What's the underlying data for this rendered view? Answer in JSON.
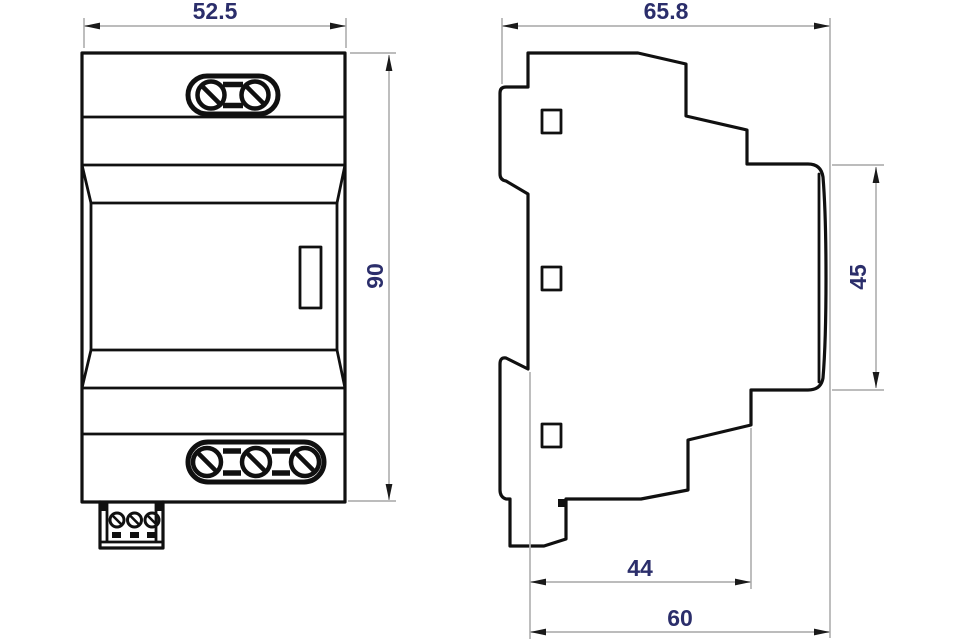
{
  "title": "DIN rail module dimensional drawing",
  "colors": {
    "background": "#ffffff",
    "outline": "#101010",
    "dimension_line": "#b3b3b3",
    "dimension_text": "#2b2e6b"
  },
  "front_view": {
    "label": "front view",
    "dims": {
      "width": "52.5",
      "height": "90"
    }
  },
  "side_view": {
    "label": "side view",
    "dims": {
      "overall_depth": "65.8",
      "face_height": "45",
      "body_depth": "44",
      "total_depth": "60"
    }
  }
}
